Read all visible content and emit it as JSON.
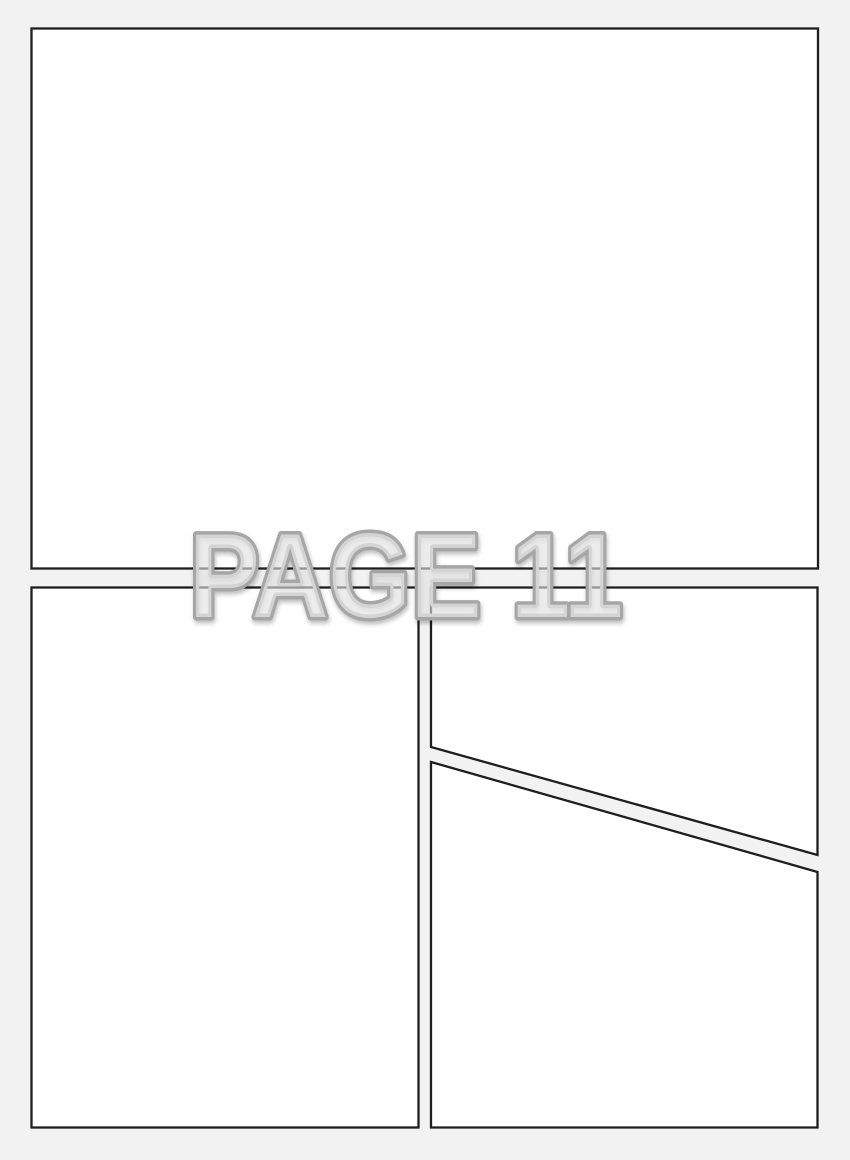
{
  "page_label": {
    "text": "PAGE 11"
  },
  "colors": {
    "background": "#f2f2f2",
    "panel_fill": "#ffffff",
    "panel_border": "#1e1e1e",
    "label_fill": "#fafafa",
    "label_outline": "#a6a6a6"
  }
}
